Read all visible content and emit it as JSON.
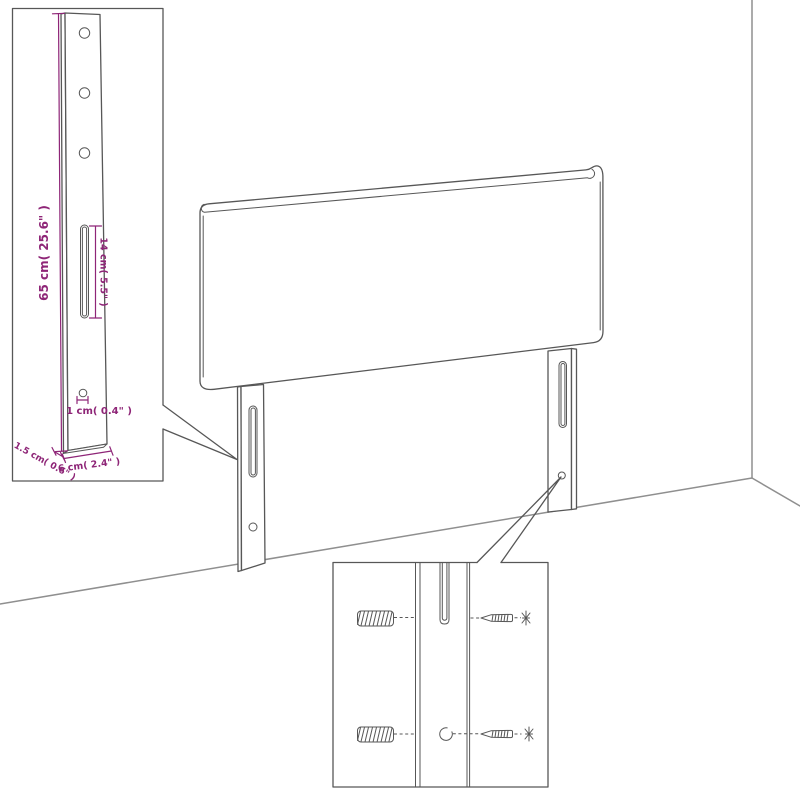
{
  "colors": {
    "bg": "#ffffff",
    "line": "#575757",
    "wall": "#8f8f8f",
    "accent": "#8e2577"
  },
  "inset_post_detail": {
    "height_label": "65 cm( 25.6\" )",
    "slot_length_label": "14 cm( 5.5\" )",
    "hole_diameter_label": "1 cm( 0.4\" )",
    "depth_label": "1.5 cm( 0.6\" )",
    "width_label": "6 cm( 2.4\" )"
  }
}
